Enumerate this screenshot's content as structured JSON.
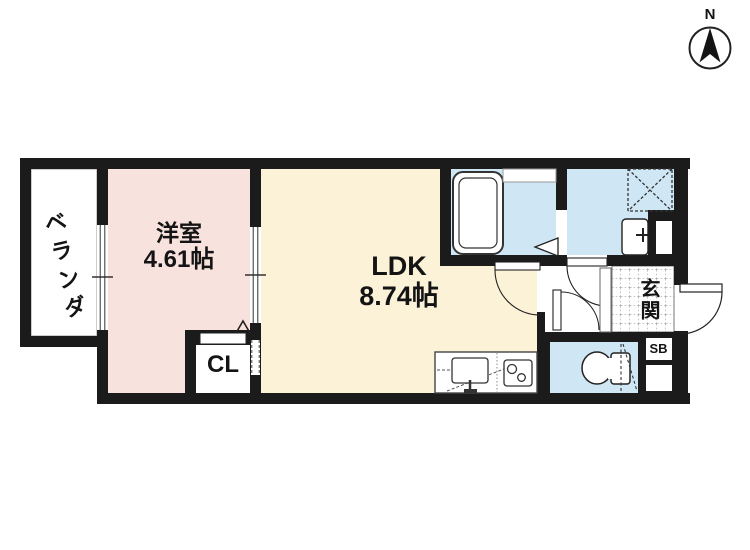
{
  "compass": {
    "north_label": "N"
  },
  "rooms": {
    "veranda": {
      "label": "ベランダ"
    },
    "bedroom": {
      "name": "洋室",
      "size": "4.61帖"
    },
    "ldk": {
      "name": "LDK",
      "size": "8.74帖"
    },
    "closet": {
      "label": "CL"
    },
    "entrance": {
      "label": "玄関"
    },
    "shoe_box": {
      "label": "SB"
    }
  },
  "colors": {
    "wall": "#1b1b1b",
    "bedroom_fill": "#f8e2dd",
    "ldk_fill": "#fcf2d7",
    "wet_area_fill": "#cfe7f5",
    "background": "#ffffff"
  }
}
